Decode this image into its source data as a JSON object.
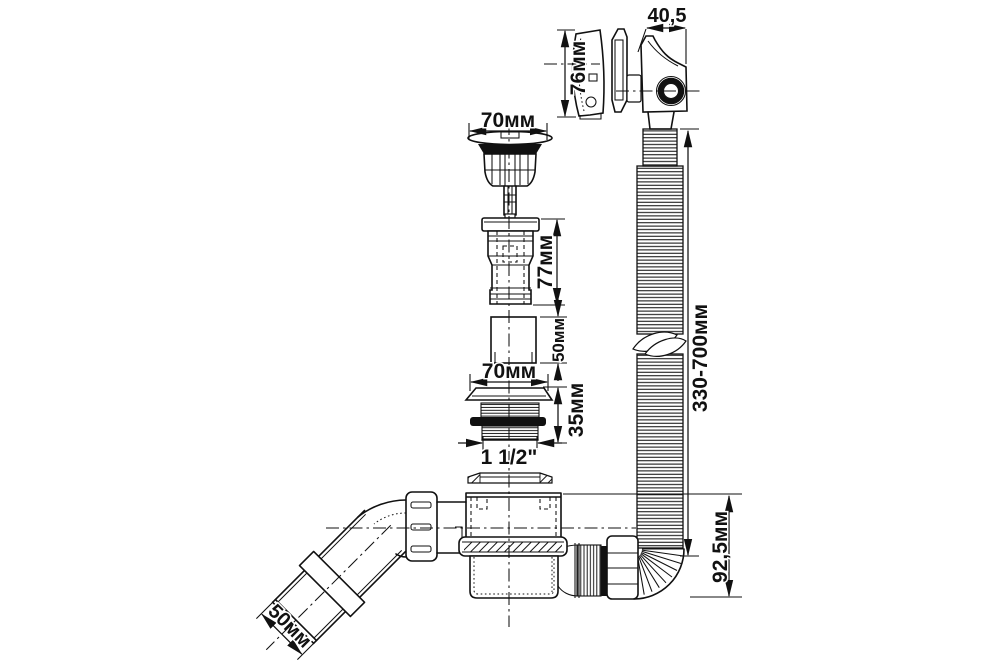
{
  "diagram": {
    "type": "technical-drawing",
    "subject": "bathtub-drain-overflow-siphon-exploded-view",
    "colors": {
      "ink": "#111111",
      "background": "#ffffff"
    }
  },
  "dims": {
    "d40_5": "40,5",
    "d76": "76мм",
    "d70_top": "70мм",
    "d77": "77мм",
    "d50_mid": "50мм",
    "d70_bottom": "70мм",
    "d35": "35мм",
    "d1_5": "1 1/2\"",
    "d330_700": "330-700мм",
    "d92_5": "92,5мм",
    "d50_pipe": "50мм"
  }
}
